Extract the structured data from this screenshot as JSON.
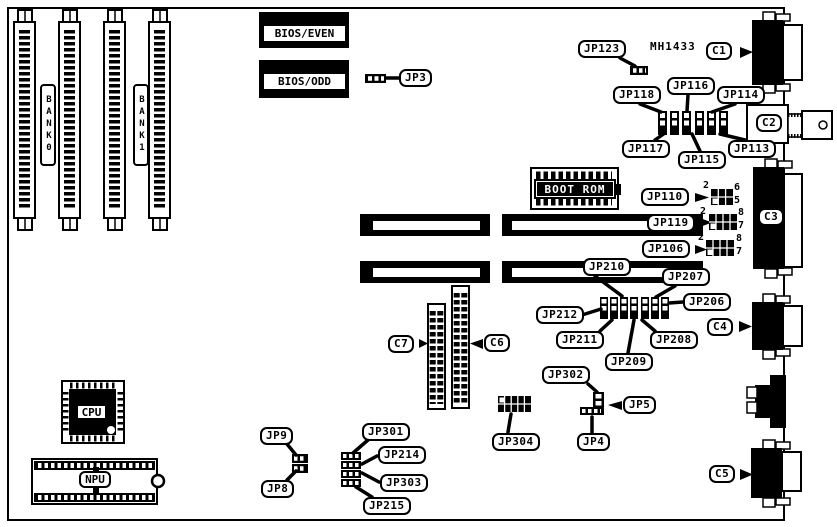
{
  "board": {
    "model": "MH1433"
  },
  "memory_banks": {
    "bank0": "BANK0",
    "bank1": "BANK1"
  },
  "chips": {
    "bios_even": "BIOS/EVEN",
    "bios_odd": "BIOS/ODD",
    "boot_rom": "BOOT ROM",
    "cpu": "CPU",
    "npu": "NPU"
  },
  "connectors": {
    "c1": "C1",
    "c2": "C2",
    "c3": "C3",
    "c4": "C4",
    "c5": "C5",
    "c6": "C6",
    "c7": "C7"
  },
  "jumpers": {
    "jp3": "JP3",
    "jp4": "JP4",
    "jp5": "JP5",
    "jp8": "JP8",
    "jp9": "JP9",
    "jp106": "JP106",
    "jp110": "JP110",
    "jp113": "JP113",
    "jp114": "JP114",
    "jp115": "JP115",
    "jp116": "JP116",
    "jp117": "JP117",
    "jp118": "JP118",
    "jp119": "JP119",
    "jp123": "JP123",
    "jp206": "JP206",
    "jp207": "JP207",
    "jp208": "JP208",
    "jp209": "JP209",
    "jp210": "JP210",
    "jp211": "JP211",
    "jp212": "JP212",
    "jp214": "JP214",
    "jp215": "JP215",
    "jp301": "JP301",
    "jp302": "JP302",
    "jp303": "JP303",
    "jp304": "JP304"
  },
  "pin_numbers": {
    "jp110": {
      "pin2": "2",
      "pin6": "6",
      "pin5": "5"
    },
    "jp119": {
      "pin2": "2",
      "pin8": "8",
      "pin7": "7"
    },
    "jp106": {
      "pin2": "2",
      "pin8": "8",
      "pin7": "7"
    }
  }
}
